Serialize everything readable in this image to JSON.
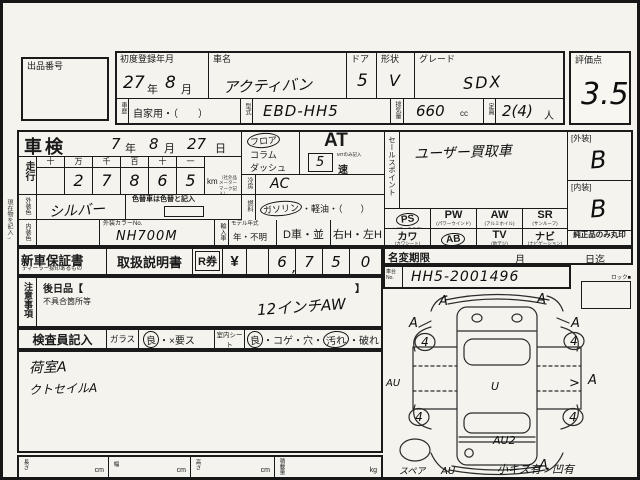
{
  "top": {
    "lot_label": "出品番号",
    "first_reg_label": "初度登録年月",
    "first_reg_year": "27",
    "year_suffix": "年",
    "first_reg_month": "8",
    "month_suffix": "月",
    "car_name_label": "車名",
    "car_name": "アクティバン",
    "door_label": "ドア",
    "door": "5",
    "shape_label": "形状",
    "shape": "V",
    "grade_label": "グレード",
    "grade": "SDX",
    "history_label": "車歴",
    "history_value": "自家用・（　　）",
    "model_label": "型式",
    "model_code": "EBD-HH5",
    "disp_label": "排気量",
    "disp": "660",
    "disp_unit": "cc",
    "cap_label": "定員",
    "cap": "2(4)",
    "cap_unit": "人",
    "score_label": "評価点",
    "score": "3.5"
  },
  "insp": {
    "shaken_label": "車検",
    "sy": "7",
    "sm": "8",
    "sd": "27",
    "ys": "年",
    "ms": "月",
    "ds": "日",
    "run_label": "走行",
    "cols": [
      "十",
      "万",
      "千",
      "百",
      "十",
      "一"
    ],
    "digits": [
      "",
      "2",
      "7",
      "8",
      "6",
      "5"
    ],
    "km": "km",
    "km_note": "（社外品メーターマーク記入）",
    "margin_note": "現在物を記入→",
    "ext_label": "外装色",
    "ext_color": "シルバー",
    "color_change": "色替車は色替と記入",
    "int_label": "内装色",
    "color_no_label": "外装カラーNo.",
    "color_no": "NH700M",
    "import_label": "輸入車",
    "my_label": "モデル年式",
    "my_value": "年・不明",
    "d_car": "D車・並",
    "handle": "右H・左H",
    "shift1": "フロア",
    "shift2": "コラム",
    "shift3": "ダッシュ",
    "at": "AT",
    "mt_val": "5",
    "mt_note": "MTのみ記入",
    "speed": "速",
    "ac_label": "冷房",
    "ac": "AC",
    "fuel_label": "燃料",
    "fuel_gas": "ガソリン",
    "fuel_rest": "・軽油・（　　）",
    "sales_label": "セールスポイント",
    "sales": "ユーザー買取車"
  },
  "equip": {
    "r1": [
      {
        "code": "PS",
        "name": "(パワーステア)"
      },
      {
        "code": "PW",
        "name": "(パワーウインド)"
      },
      {
        "code": "AW",
        "name": "(アルミホイル)"
      },
      {
        "code": "SR",
        "name": "(サンルーフ)"
      }
    ],
    "r2": [
      {
        "code": "カワ",
        "name": "(カワシート)"
      },
      {
        "code": "AB",
        "name": "(エアバッグ)"
      },
      {
        "code": "TV",
        "name": "(地デジ)"
      },
      {
        "code": "ナビ",
        "name": "(ナビゲーション)"
      }
    ]
  },
  "grades": {
    "ext_label": "[外装]",
    "ext": "B",
    "int_label": "[内装]",
    "int": "B",
    "genuine": "純正品のみ丸印"
  },
  "docs": {
    "warranty": "新車保証書",
    "warranty_sub": "ディーラー捺印あるもの",
    "manual": "取扱説明書",
    "r_label": "R券",
    "yen": "¥",
    "cells": [
      "",
      "6",
      "7",
      "5",
      "0"
    ],
    "comma": ",",
    "namechange_label": "名変期限",
    "nm_month": "月",
    "nm_day": "日迄",
    "chassis_label": "車台No.",
    "chassis": "HH5-2001496",
    "lock_label": "ロック■"
  },
  "caution": {
    "label": "注意事項",
    "later": "後日品【",
    "later_close": "】",
    "defect": "不具合箇所等",
    "note": "12インチAW"
  },
  "inspector": {
    "label": "検査員記入",
    "glass_label": "ガラス",
    "glass_good": "良",
    "glass_rest": "・×要ス",
    "seat_label": "室内シート",
    "seat_good": "良",
    "seat_mid": "・コゲ・穴・",
    "seat_dirty": "汚れ",
    "seat_end": "・破れ",
    "note1": "荷室A",
    "note2": "クトセイルA"
  },
  "dims": [
    {
      "label": "長さ",
      "unit": "cm"
    },
    {
      "label": "幅",
      "unit": "cm"
    },
    {
      "label": "高さ",
      "unit": "cm"
    },
    {
      "label": "積載量",
      "unit": "kg"
    }
  ],
  "diagram": {
    "spare": "スペア",
    "bottom_note": "小キズ有・凹有",
    "marks": {
      "front_left": "A",
      "front_right": "A",
      "fender_left": "A",
      "fender_right": "A",
      "wheel_fl": "4",
      "wheel_fr": "4",
      "wheel_rl": "4",
      "wheel_rr": "4",
      "side_left": "AU",
      "side_right": "A",
      "side_tick": ">",
      "center": "U",
      "rear_center": "AU2",
      "rear_left": "AU",
      "rear_right": "A"
    }
  }
}
